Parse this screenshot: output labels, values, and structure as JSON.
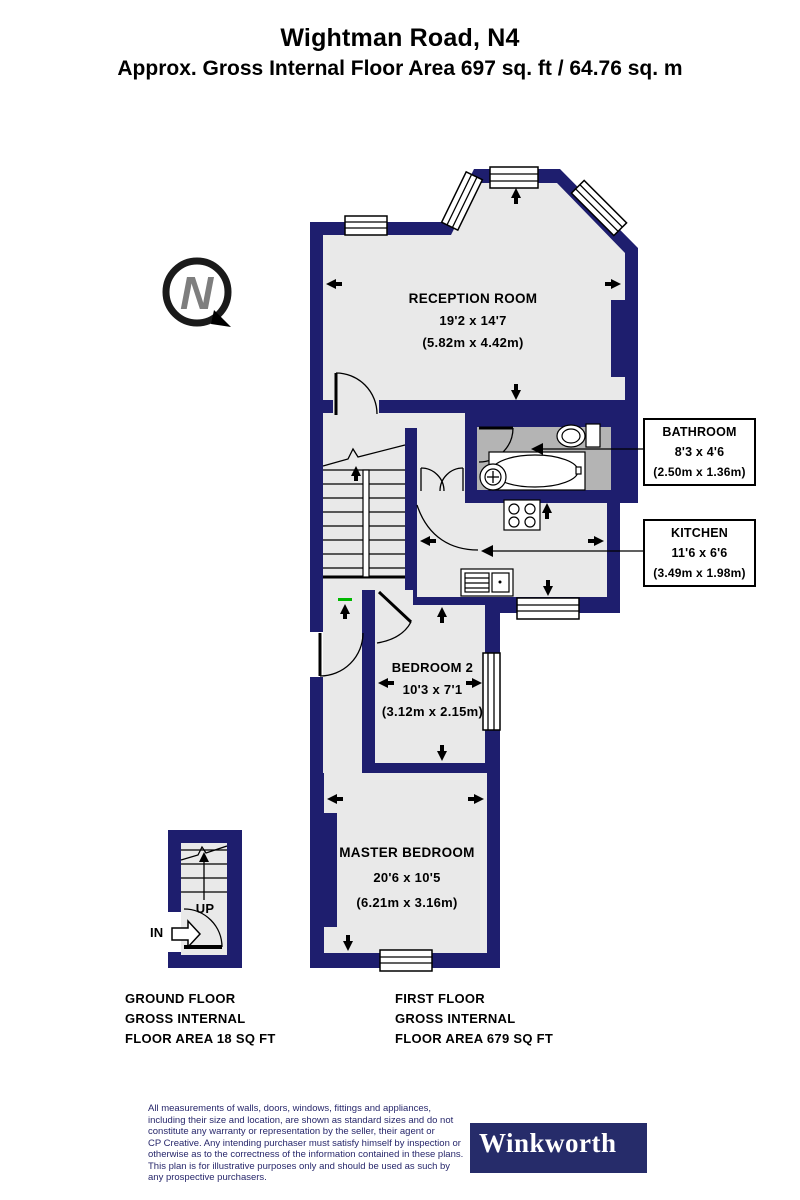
{
  "title": "Wightman Road, N4",
  "subtitle": "Approx. Gross Internal Floor Area 697 sq. ft / 64.76 sq. m",
  "compass": {
    "letter": "N"
  },
  "rooms": {
    "reception": {
      "name": "RECEPTION ROOM",
      "dims_ft": "19'2 x 14'7",
      "dims_m": "(5.82m x 4.42m)"
    },
    "bathroom": {
      "name": "BATHROOM",
      "dims_ft": "8'3 x 4'6",
      "dims_m": "(2.50m x 1.36m)"
    },
    "kitchen": {
      "name": "KITCHEN",
      "dims_ft": "11'6 x 6'6",
      "dims_m": "(3.49m x 1.98m)"
    },
    "bedroom2": {
      "name": "BEDROOM 2",
      "dims_ft": "10'3 x 7'1",
      "dims_m": "(3.12m x 2.15m)"
    },
    "master": {
      "name": "MASTER BEDROOM",
      "dims_ft": "20'6 x 10'5",
      "dims_m": "(6.21m x 3.16m)"
    }
  },
  "stairs": {
    "up_label": "UP",
    "in_label": "IN"
  },
  "floor_summaries": {
    "ground": {
      "lines": [
        "GROUND FLOOR",
        "GROSS INTERNAL",
        "FLOOR AREA 18 SQ FT"
      ]
    },
    "first": {
      "lines": [
        "FIRST FLOOR",
        "GROSS INTERNAL",
        "FLOOR AREA 679 SQ FT"
      ]
    }
  },
  "footer": {
    "disclaimer_lines": [
      "All measurements of walls, doors, windows, fittings and appliances,",
      "including their size and location, are shown as standard sizes and do not",
      "constitute any warranty or representation by the seller, their agent or",
      "CP Creative. Any intending purchaser must satisfy himself by inspection or",
      "otherwise as to the correctness of the information contained in these plans.",
      "This plan is for illustrative purposes only and should be used as such by",
      "any prospective purchasers."
    ],
    "brand": "Winkworth"
  },
  "colors": {
    "wall": "#1e1e6e",
    "floor": "#e9e9e9",
    "bathroom_floor": "#b4b4b4",
    "accent_green": "#00b800",
    "logo_background": "#262c6a",
    "disclaimer_ink": "#27276b"
  }
}
